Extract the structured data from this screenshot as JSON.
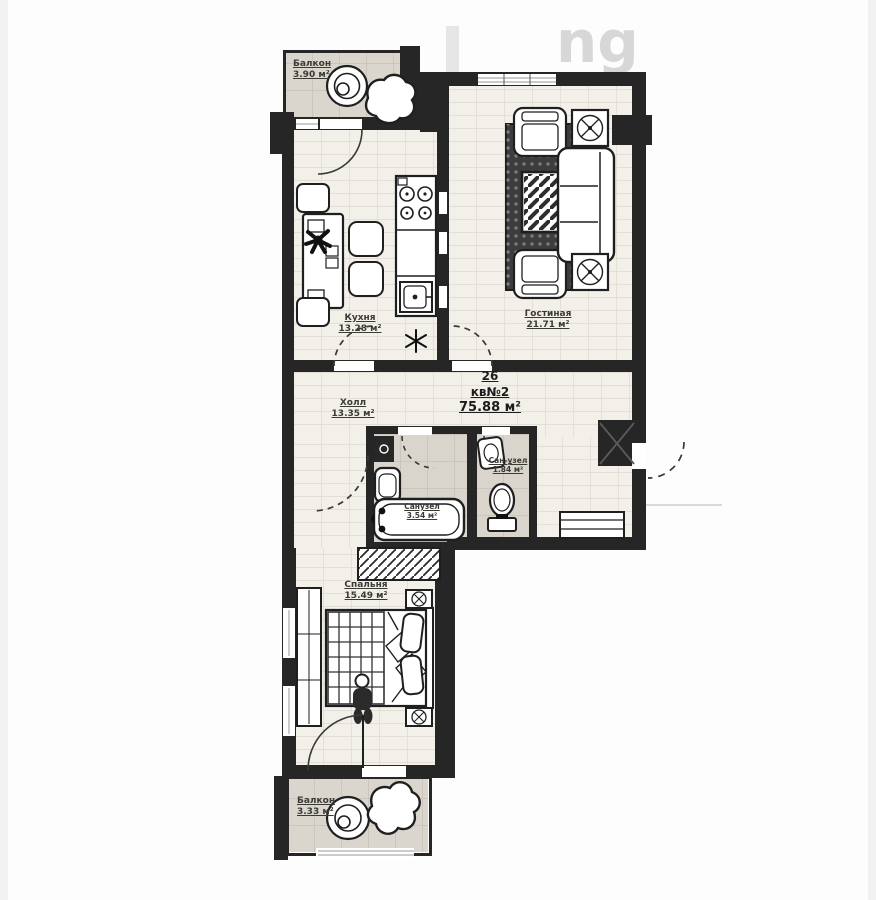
{
  "watermark": {
    "text": "ng"
  },
  "apartment": {
    "block_number": "26",
    "unit": "кв№2",
    "total_area": "75.88 м²"
  },
  "rooms": {
    "balcony_top": {
      "name": "Балкон",
      "area": "3.90 м²"
    },
    "kitchen": {
      "name": "Кухня",
      "area": "13.28 м²"
    },
    "living_room": {
      "name": "Гостиная",
      "area": "21.71 м²"
    },
    "hall": {
      "name": "Холл",
      "area": "13.35 м²"
    },
    "bathroom": {
      "name": "Санузел",
      "area": "3.54 м²"
    },
    "wc": {
      "name": "Сан-узел",
      "area": "1.84 м²"
    },
    "bedroom": {
      "name": "Спальня",
      "area": "15.49 м²"
    },
    "balcony_bottom": {
      "name": "Балкон",
      "area": "3.33 м²"
    }
  },
  "colors": {
    "wall": "#262626",
    "brick_floor": "#f3f0ea",
    "tile_floor": "#dad6ce",
    "label_text": "#3b3b36"
  }
}
